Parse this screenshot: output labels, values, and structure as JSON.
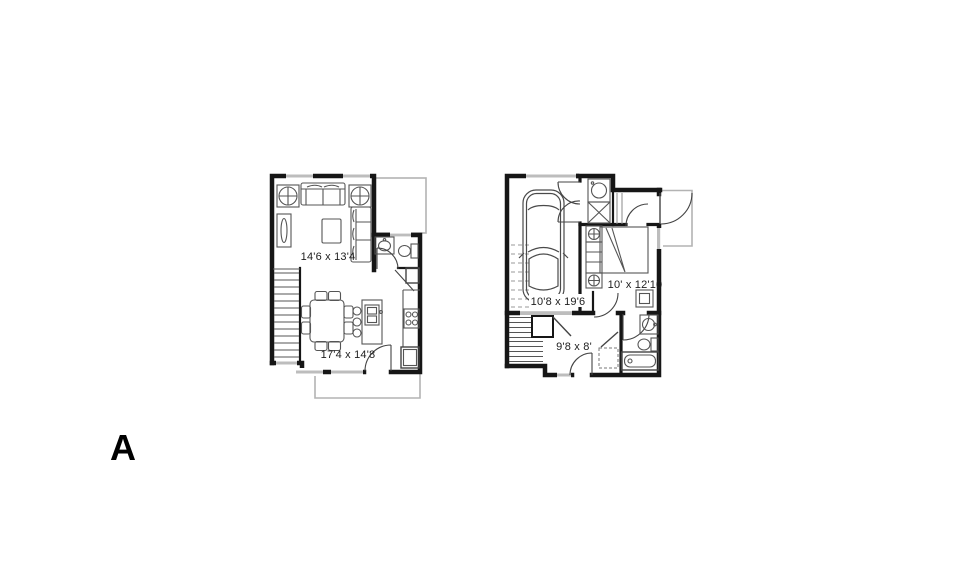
{
  "plan_label": "A",
  "colors": {
    "background": "#ffffff",
    "wall": "#161616",
    "furniture_line": "#555555",
    "window_gray": "#bdbdbd",
    "outside_outline_gray": "#b3b3b3",
    "text": "#1d1d1d"
  },
  "floor1": {
    "name": "upper-floor-plan",
    "rooms": [
      {
        "name": "living-room",
        "dimension": "14'6 x 13'4"
      },
      {
        "name": "dining-kitchen",
        "dimension": "17'4 x 14'8"
      }
    ]
  },
  "floor2": {
    "name": "entry-floor-plan",
    "rooms": [
      {
        "name": "garage",
        "dimension": "10'8 x 19'6"
      },
      {
        "name": "bedroom",
        "dimension": "10' x 12'10"
      },
      {
        "name": "den",
        "dimension": "9'8 x 8'"
      }
    ]
  },
  "icons": [
    "sofa-icon",
    "armchair-icon",
    "tv-console-icon",
    "coffee-table-icon",
    "sectional-sofa-icon",
    "dining-table-icon",
    "chair-icon",
    "kitchen-island-icon",
    "island-sink-icon",
    "stool-icon",
    "stove-icon",
    "refrigerator-icon",
    "vanity-sink-icon",
    "toilet-icon",
    "stairs-icon",
    "car-icon",
    "washer-icon",
    "dryer-icon",
    "bed-icon",
    "nightstand-icon",
    "dresser-icon",
    "desk-icon",
    "bathtub-icon",
    "patio-outline",
    "porch-outline",
    "garage-door",
    "window",
    "door-swing"
  ]
}
